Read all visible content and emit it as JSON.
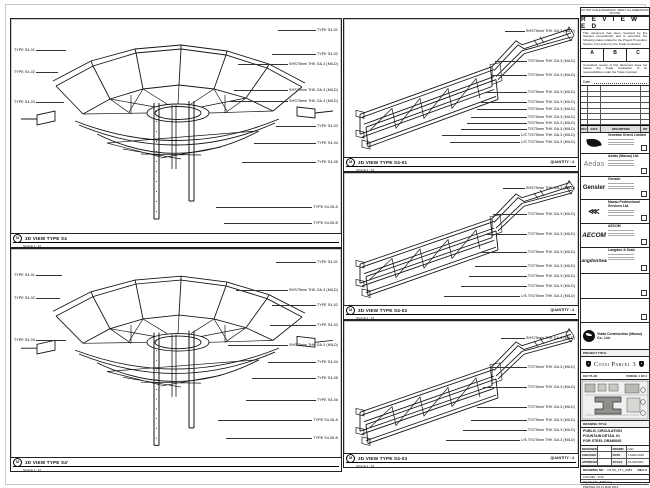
{
  "sheet": {
    "background": "#ffffff",
    "line_color": "#161616"
  },
  "panels": {
    "s4_top": {
      "bubble": "01",
      "title": "3D VIEW TYPE S4",
      "scale": "SCALE 1 : 10",
      "callouts_left": [
        "TYPE S4-01",
        "TYPE S4-02",
        "TYPE S4-03"
      ],
      "callouts_right": [
        "TYPE S4-01",
        "TYPE S4-02",
        "SHS75mm THK GA.3 (MILD)",
        "SHS75mm THK GA.3 (MILD)",
        "SHS75mm THK GA.3 (MILD)",
        "TYPE S4-03",
        "TYPE S4-04",
        "TYPE S4-05",
        "TYPE S4-05.A",
        "TYPE S4-05.B"
      ]
    },
    "s4_bottom": {
      "bubble": "02",
      "title": "3D VIEW TYPE S4'",
      "scale": "SCALE 1 : 10",
      "callouts_left": [
        "TYPE S4-01",
        "TYPE S4-02",
        "TYPE S4-03"
      ],
      "callouts_right": [
        "TYPE S4-01",
        "SHS75mm THK GA.3 (MILD)",
        "TYPE S4-02",
        "TYPE S4-03",
        "SHS75mm THK GA.3 (MILD)",
        "TYPE S4-04",
        "TYPE S4-05",
        "TYPE S4-06",
        "TYPE S4-06.A",
        "TYPE S4-06.B"
      ]
    },
    "mid1": {
      "bubble": "03",
      "title": "3D VIEW TYPE S4-01",
      "scale": "SCALE 1 : 10",
      "quantity": "QUANTITY : 4",
      "callouts_right": [
        "SHS75mm THK GA.3 (MILD)",
        "T/S75mm THK GA.3 (MILD)",
        "T/S75mm THK GA.3 (MILD)",
        "T/S75mm THK GA.3 (MILD)",
        "T/S75mm THK GA.3 (MILD)",
        "T/S75mm THK GA.3 (MILD)",
        "T/S75mm THK GA.3 (MILD)",
        "T/S75mm THK GA.3 (MILD)",
        "T/S75mm THK GA.3 (MILD)",
        "L/S T/S75mm THK GA.3 (MILD)",
        "L/S T/S75mm THK GA.3 (MILD)"
      ]
    },
    "mid2": {
      "bubble": "04",
      "title": "3D VIEW TYPE S4-02",
      "scale": "SCALE 1 : 10",
      "quantity": "QUANTITY : 4",
      "callouts_right": [
        "SHS75mm THK GA.3 (MILD)",
        "T/S75mm THK GA.3 (MILD)",
        "T/S75mm THK GA.3 (MILD)",
        "T/S75mm THK GA.3 (MILD)",
        "T/S75mm THK GA.3 (MILD)",
        "T/S75mm THK GA.3 (MILD)",
        "T/S75mm THK GA.3 (MILD)",
        "L/S T/S75mm THK GA.3 (MILD)"
      ]
    },
    "mid3": {
      "bubble": "05",
      "title": "3D VIEW TYPE S4-03",
      "scale": "SCALE 1 : 10",
      "quantity": "QUANTITY : 4",
      "callouts_right": [
        "SHS75mm THK GA.3 (MILD)",
        "T/S75mm THK GA.3 (MILD)",
        "T/S75mm THK GA.3 (MILD)",
        "T/S75mm THK GA.3 (MILD)",
        "T/S75mm THK GA.3 (MILD)",
        "T/S75mm THK GA.3 (MILD)",
        "L/S T/S75mm THK GA.3 (MILD)"
      ]
    }
  },
  "titleblock": {
    "note": "DO NOT SCALE DRAWINGS. VERIFY ALL DIMENSIONS ON SITE.",
    "reviewed": {
      "title": "R E V I E W E D",
      "para1": "This document has been reviewed by the relevant consultant(s) and is accorded the following status related to the Project Procedure Section 4 for action by the Trade Contractor.",
      "options": [
        "A",
        "B",
        "C"
      ],
      "para2": "Consultant review of this document does not relieve the Trade Contractor of its responsibilities under the Trade Contract.",
      "date_label": "Date :"
    },
    "revision": {
      "header": [
        "REV",
        "DATE",
        "DESCRIPTION",
        "INT"
      ]
    },
    "consultants": [
      {
        "logo": "",
        "name": "Venetian Orient Limited"
      },
      {
        "logo": "Aedas",
        "name": "Aedas (Macau) Ltd."
      },
      {
        "logo": "Gensler",
        "name": "Gensler"
      },
      {
        "logo": "⋘",
        "name": "Macau Professional Services Ltd."
      },
      {
        "logo": "AECOM",
        "name": "AECOM"
      },
      {
        "logo": "LangdonSeah",
        "name": "Langdon & Seah"
      },
      {
        "logo": "",
        "name": ""
      },
      {
        "logo": "",
        "name": ""
      }
    ],
    "contractor": {
      "name": "Yidda Construction (Macau) Co., Ltd."
    },
    "project": {
      "label": "PROJECT TITLE",
      "name": "Cotai Parcel 3"
    },
    "keyplan": {
      "left": "KEY PLAN",
      "right": "PARCEL 1 OF 3"
    },
    "drawing_title": {
      "label": "DRAWING TITLE",
      "line1": "PUBLIC CIRCULATION",
      "line2": "FOUNTAIN DETAIL 01",
      "line3": "FOR STEEL DRAWING"
    },
    "signoff": {
      "designed": "DESIGNED",
      "designed_v": "",
      "drawn": "DRAWN",
      "drawn_v": "CAD",
      "checked": "CHECKED",
      "checked_v": "-",
      "date": "DATE",
      "date_v": "7-MAR-2016",
      "approved": "APPROVED",
      "approved_v": "-",
      "scale": "SCALE",
      "scale_v": "AS SHOWN"
    },
    "drawing_no": {
      "label": "DRAWING NO :",
      "value": "P3-SK_FTL_8484",
      "rev": "REV A"
    },
    "files": {
      "row1": "CAD REF : 3722",
      "row2": "P3_SK_FTL_8484.dwg",
      "row3": "PRINTED ON 14 MAR 2016"
    }
  }
}
